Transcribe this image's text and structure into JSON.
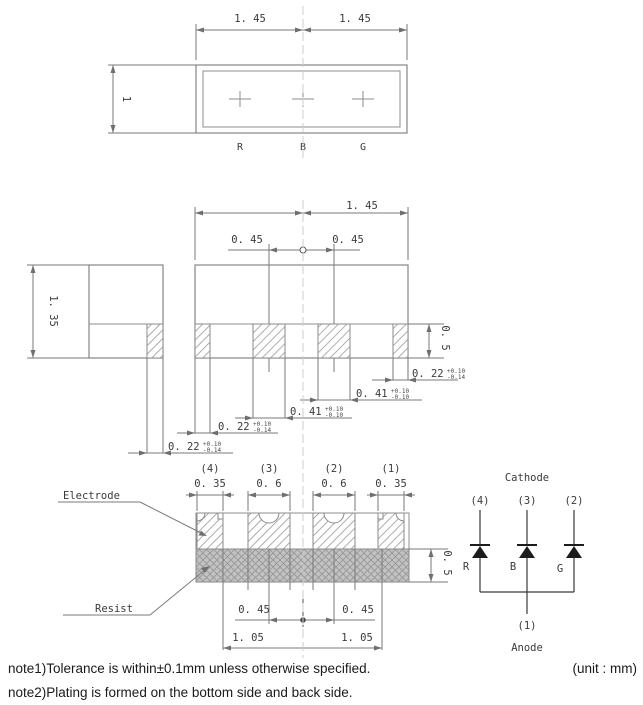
{
  "drawing": {
    "top_view": {
      "dim_left": "1. 45",
      "dim_right": "1. 45",
      "dim_depth": "1",
      "die_labels": [
        "R",
        "B",
        "G"
      ]
    },
    "side_view": {
      "dim_height": "1. 35"
    },
    "back_view": {
      "dim_width": "1. 45",
      "dim_left_pitch": "0. 45",
      "dim_right_pitch": "0. 45",
      "dim_pad_height": "0. 5",
      "callouts": [
        {
          "value": "0. 22",
          "tol_plus": "+0.10",
          "tol_minus": "-0.14"
        },
        {
          "value": "0. 22",
          "tol_plus": "+0.10",
          "tol_minus": "-0.14"
        },
        {
          "value": "0. 41",
          "tol_plus": "+0.10",
          "tol_minus": "-0.10"
        },
        {
          "value": "0. 41",
          "tol_plus": "+0.10",
          "tol_minus": "-0.10"
        },
        {
          "value": "0. 22",
          "tol_plus": "+0.10",
          "tol_minus": "-0.14"
        }
      ]
    },
    "bottom_view": {
      "electrode_label": "Electrode",
      "resist_label": "Resist",
      "pad_numbers": [
        "(4)",
        "(3)",
        "(2)",
        "(1)"
      ],
      "pad_widths": [
        "0. 35",
        "0. 6",
        "0. 6",
        "0. 35"
      ],
      "dim_resist_height": "0. 5",
      "dim_inner_left": "0. 45",
      "dim_inner_right": "0. 45",
      "dim_outer_left": "1. 05",
      "dim_outer_right": "1. 05"
    },
    "circuit": {
      "cathode": "Cathode",
      "anode": "Anode",
      "top_pins": [
        "(4)",
        "(3)",
        "(2)"
      ],
      "bottom_pin": "(1)",
      "diodes": [
        "R",
        "B",
        "G"
      ]
    },
    "notes": {
      "note1": "note1)Tolerance is within±0.1mm unless otherwise specified.",
      "unit": "(unit : mm)",
      "note2": "note2)Plating is formed on the bottom side and back side."
    }
  }
}
